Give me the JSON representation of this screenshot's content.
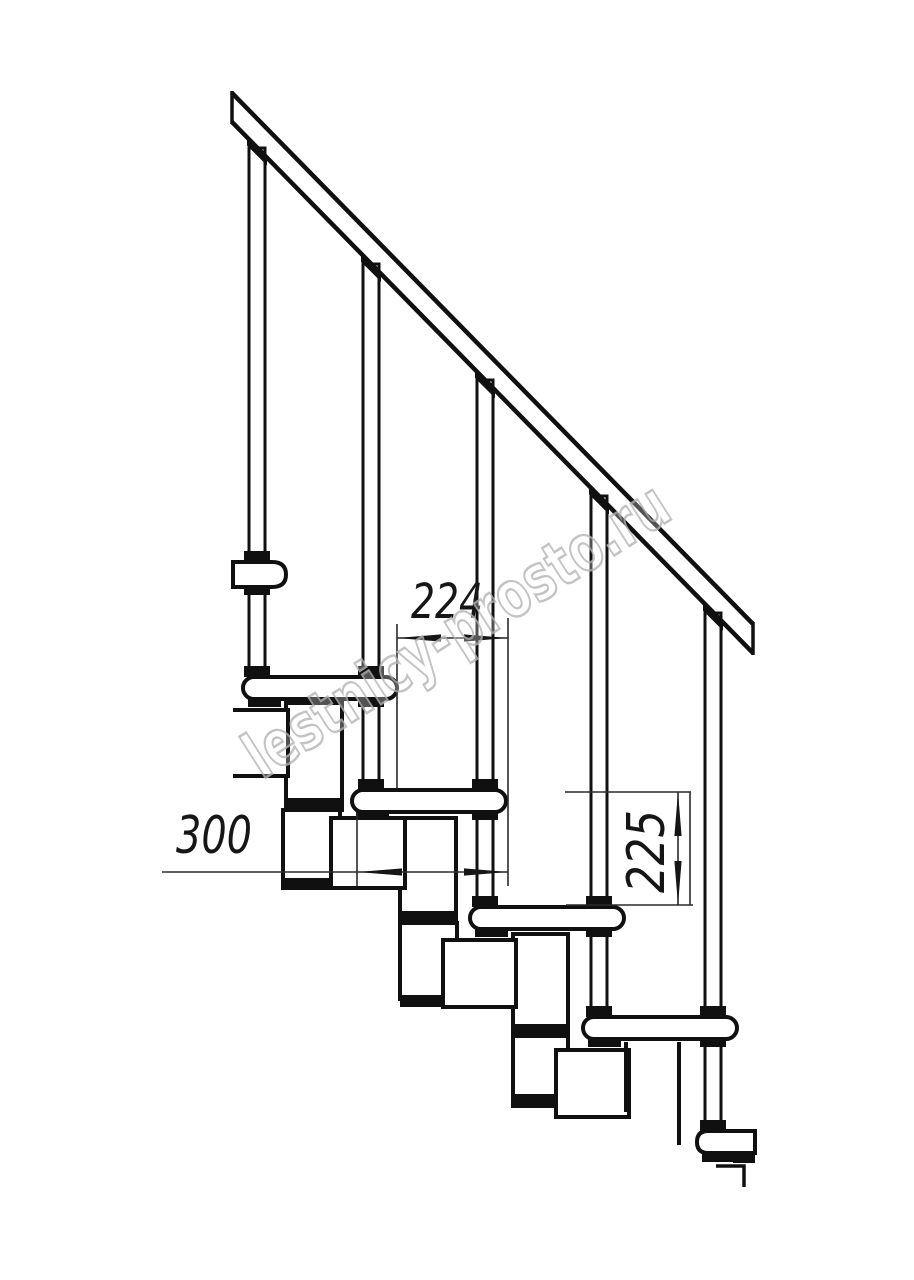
{
  "drawing": {
    "subject": "modular staircase side elevation",
    "ink_color": "#101010",
    "dimension_line_color": "#2a2a2a"
  },
  "dimensions": {
    "horizontal_spacing": "224",
    "tread_depth": "300",
    "step_height": "225"
  },
  "watermark": {
    "text": "lestnicy-prosto.ru",
    "color": "#b5b5b5"
  }
}
